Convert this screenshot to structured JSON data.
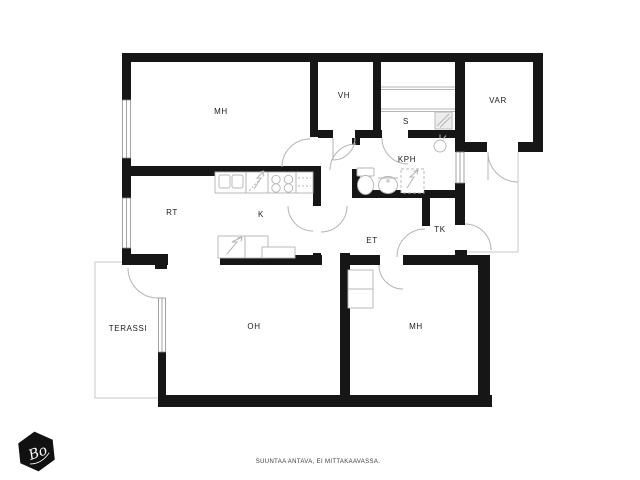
{
  "plan": {
    "rooms": {
      "mh1": {
        "label": "MH"
      },
      "vh": {
        "label": "VH"
      },
      "s": {
        "label": "S"
      },
      "var": {
        "label": "VAR"
      },
      "kph": {
        "label": "KPH"
      },
      "rt": {
        "label": "RT"
      },
      "k": {
        "label": "K"
      },
      "et": {
        "label": "ET"
      },
      "tk": {
        "label": "TK"
      },
      "oh": {
        "label": "OH"
      },
      "mh2": {
        "label": "MH"
      },
      "terassi": {
        "label": "TERASSI"
      }
    },
    "annotations": {
      "disclaimer": "SUUNTAA ANTAVA, EI MITTAKAAVASSA."
    },
    "logo": {
      "text": "Bo"
    },
    "colors": {
      "wall": "#161616",
      "line": "#b4b4b4",
      "outline": "#c9c9c9",
      "label": "#1c1c1c"
    }
  }
}
